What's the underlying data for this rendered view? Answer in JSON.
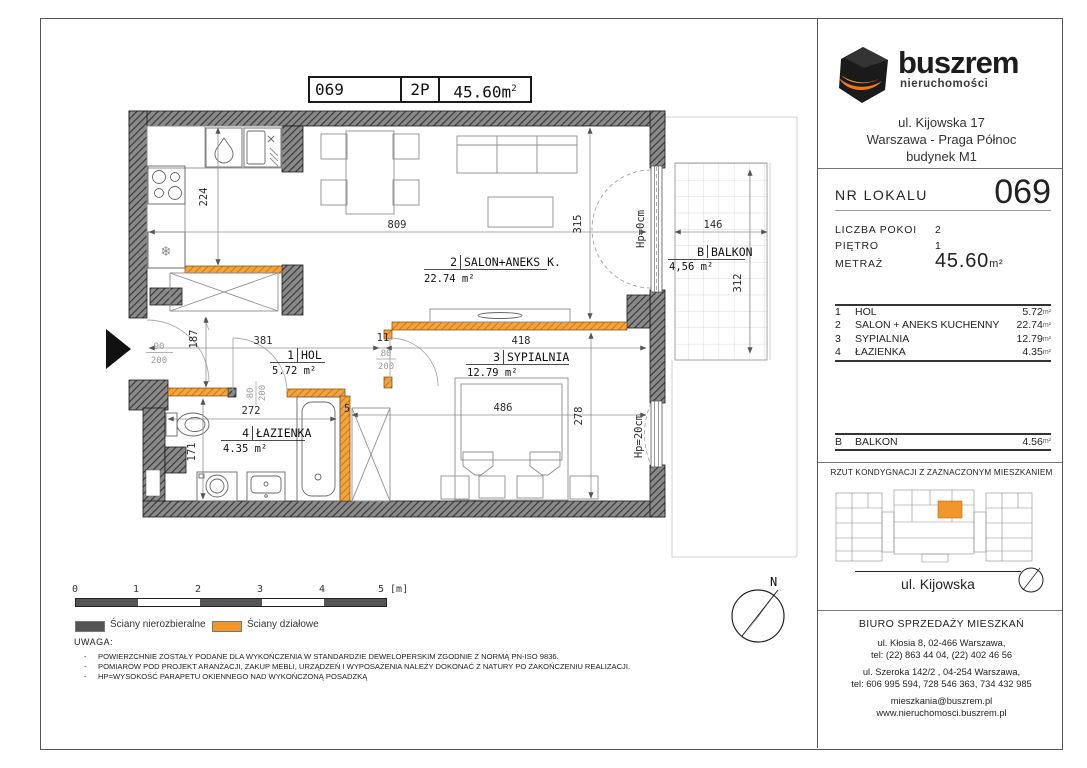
{
  "title_block": {
    "number": "069",
    "rooms_code": "2P",
    "area_value": "45.60m",
    "area_sup": "2"
  },
  "logo": {
    "brand": "buszrem",
    "subtitle": "nieruchomości"
  },
  "address": {
    "line1": "ul. Kijowska 17",
    "line2": "Warszawa - Praga Północ",
    "line3": "budynek M1"
  },
  "unit": {
    "label": "NR LOKALU",
    "number": "069",
    "fields": [
      {
        "label": "LICZBA POKOI",
        "value": "2"
      },
      {
        "label": "PIĘTRO",
        "value": "1"
      }
    ],
    "area_label": "METRAŻ",
    "area_value": "45.60",
    "area_unit": "m²"
  },
  "area_unit": "m²",
  "rooms": [
    {
      "no": "1",
      "name": "HOL",
      "area": "5.72"
    },
    {
      "no": "2",
      "name": "SALON + ANEKS KUCHENNY",
      "area": "22.74"
    },
    {
      "no": "3",
      "name": "SYPIALNIA",
      "area": "12.79"
    },
    {
      "no": "4",
      "name": "ŁAZIENKA",
      "area": "4.35"
    }
  ],
  "balcony_row": {
    "no": "B",
    "name": "BALKON",
    "area": "4.56"
  },
  "key_plan": {
    "title": "RZUT KONDYGNACJI Z ZAZNACZONYM MIESZKANIEM",
    "street": "ul. Kijowska"
  },
  "sales_office": {
    "title": "BIURO SPRZEDAŻY MIESZKAŃ",
    "address1": "ul. Kłosia 8, 02-466 Warszawa,",
    "phone1": "tel: (22) 863 44 04, (22) 402 46 56",
    "address2": "ul. Szeroka 142/2 , 04-254 Warszawa,",
    "phone2": "tel: 606 995 594, 728 546 363, 734 432 985",
    "email": "mieszkania@buszrem.pl",
    "website": "www.nieruchomosci.buszrem.pl"
  },
  "legend": {
    "scale_ticks": [
      "0",
      "1",
      "2",
      "3",
      "4",
      "5 [m]"
    ],
    "solid_walls": "Ściany nierozbieralne",
    "partition_walls": "Ściany działowe",
    "note_title": "UWAGA:",
    "notes": [
      "POWIERZCHNIE ZOSTAŁY PODANE DLA WYKOŃCZENIA W STANDARDZIE DEWELOPERSKIM ZGODNIE Z NORMĄ PN-ISO 9836.",
      "POMIARÓW POD PROJEKT ARANŻACJI, ZAKUP MEBLI, URZĄDZEŃ I WYPOSAŻENIA NALEŻY DOKONAĆ Z NATURY PO ZAKOŃCZENIU REALIZACJI.",
      "HP=WYSOKOŚĆ PARAPETU OKIENNEGO NAD WYKOŃCZONĄ POSADZKĄ"
    ]
  },
  "plan": {
    "rooms": {
      "salon": {
        "no": "2",
        "name": "SALON+ANEKS K.",
        "area": "22.74 m²"
      },
      "hol": {
        "no": "1",
        "name": "HOL",
        "area": "5.72 m²"
      },
      "sypialnia": {
        "no": "3",
        "name": "SYPIALNIA",
        "area": "12.79 m²"
      },
      "lazienka": {
        "no": "4",
        "name": "ŁAZIENKA",
        "area": "4.35 m²"
      },
      "balkon": {
        "no": "B",
        "name": "BALKON",
        "area": "4,56 m²"
      }
    },
    "dims": {
      "salon_width": "809",
      "salon_height": "315",
      "kitchen_depth": "224",
      "hol_height": "187",
      "hol_width": "381",
      "jamb": "11",
      "bedroom_width": "418",
      "bath_width": "272",
      "bath_height": "171",
      "bedroom_span": "486",
      "bedroom_height": "278",
      "balcony_width": "146",
      "balcony_depth": "312",
      "partition": "5"
    },
    "doors": {
      "entrance_w": "90",
      "entrance_h": "200",
      "bath_w": "80",
      "bath_h": "200",
      "bedroom_w": "80",
      "bedroom_h": "200"
    },
    "windows": {
      "balcony_door_sill": "Hp=0cm",
      "bedroom_sill": "Hp=20cm"
    },
    "north_label": "N"
  },
  "icons": {
    "fridge_snowflake": "❄"
  },
  "colors": {
    "partition_orange": "#f0962a",
    "wall_gray": "#555555",
    "highlight_orange": "#f0962a"
  }
}
